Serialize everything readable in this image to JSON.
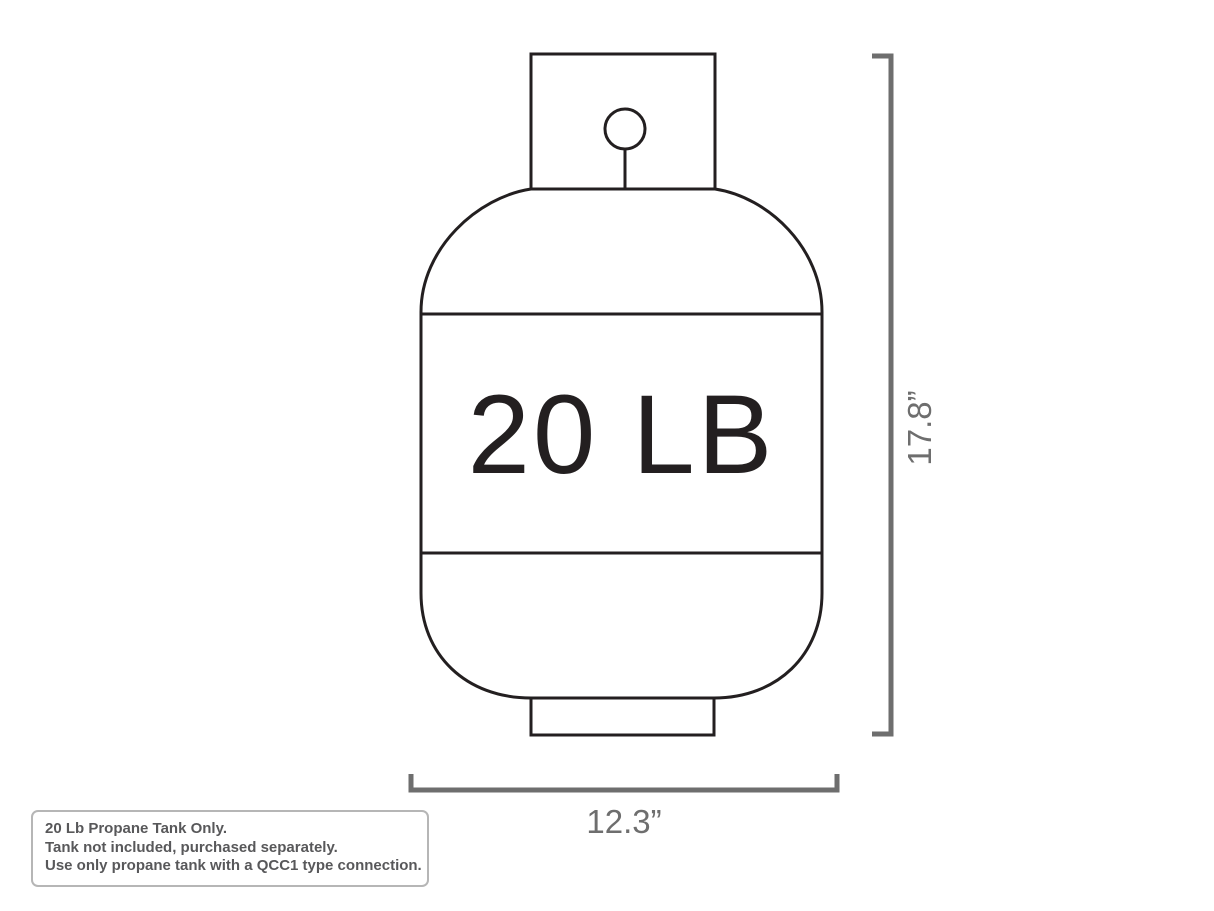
{
  "title": "20 lb propane tank dimension diagram",
  "tank": {
    "label": "20 LB"
  },
  "dimensions": {
    "height": {
      "value": "17.8”"
    },
    "width": {
      "value": "12.3”"
    }
  },
  "note": {
    "lines": [
      "20 Lb Propane Tank Only.",
      "Tank not included, purchased separately.",
      "Use only propane tank with a QCC1 type connection."
    ]
  },
  "colors": {
    "line-color": "#231f20",
    "dim-color": "#6e6e6e",
    "note-text-color": "#58585a",
    "note-border-color": "#b6b6b6",
    "background": "#ffffff"
  }
}
